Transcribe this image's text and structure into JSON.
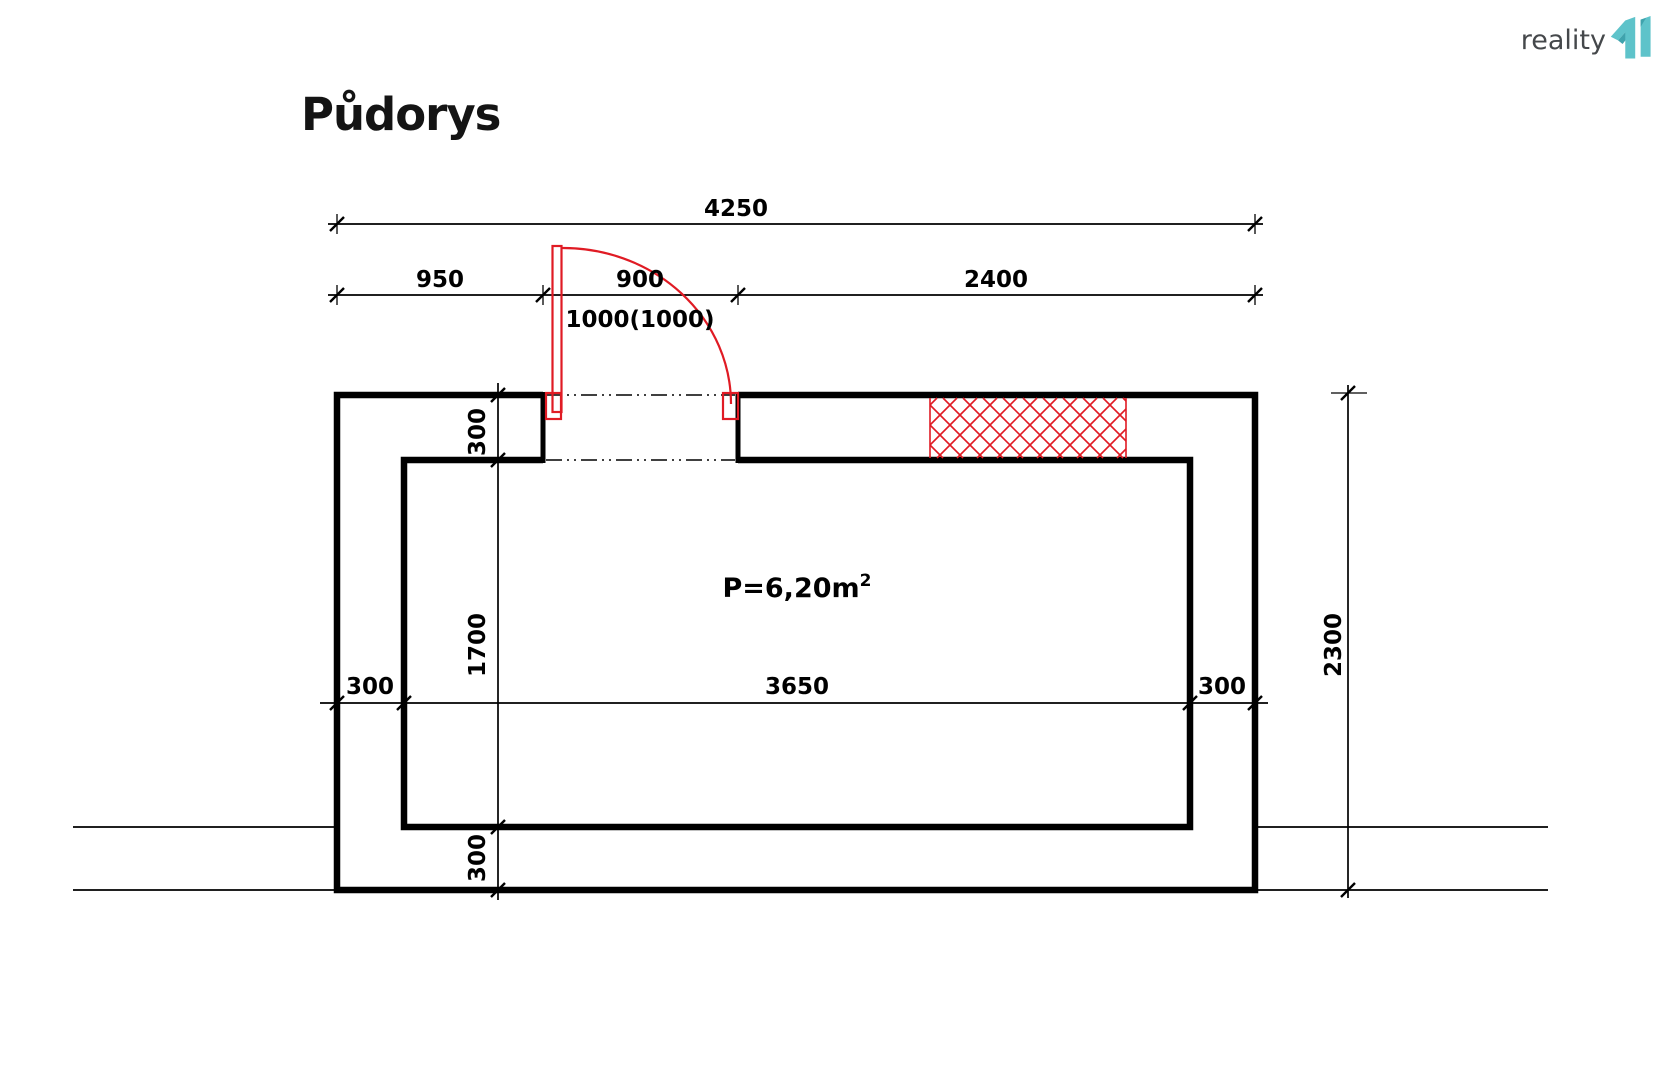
{
  "title": "Půdorys",
  "logo": {
    "text": "reality",
    "mark": "11"
  },
  "area_label": {
    "main": "P=6,20m",
    "sup": "2"
  },
  "dimensions": {
    "total_width": "4250",
    "left_segment": "950",
    "door_opening": "900",
    "right_segment": "2400",
    "door_note": "1000(1000)",
    "wall_top": "300",
    "room_height": "1700",
    "wall_bottom": "300",
    "wall_left": "300",
    "room_width": "3650",
    "wall_right": "300",
    "total_height": "2300"
  },
  "colors": {
    "line": "#000000",
    "red": "#e01b24",
    "teal": "#5ec3ca",
    "teal_dark": "#3fa3ad",
    "logo_text": "#45484b"
  }
}
